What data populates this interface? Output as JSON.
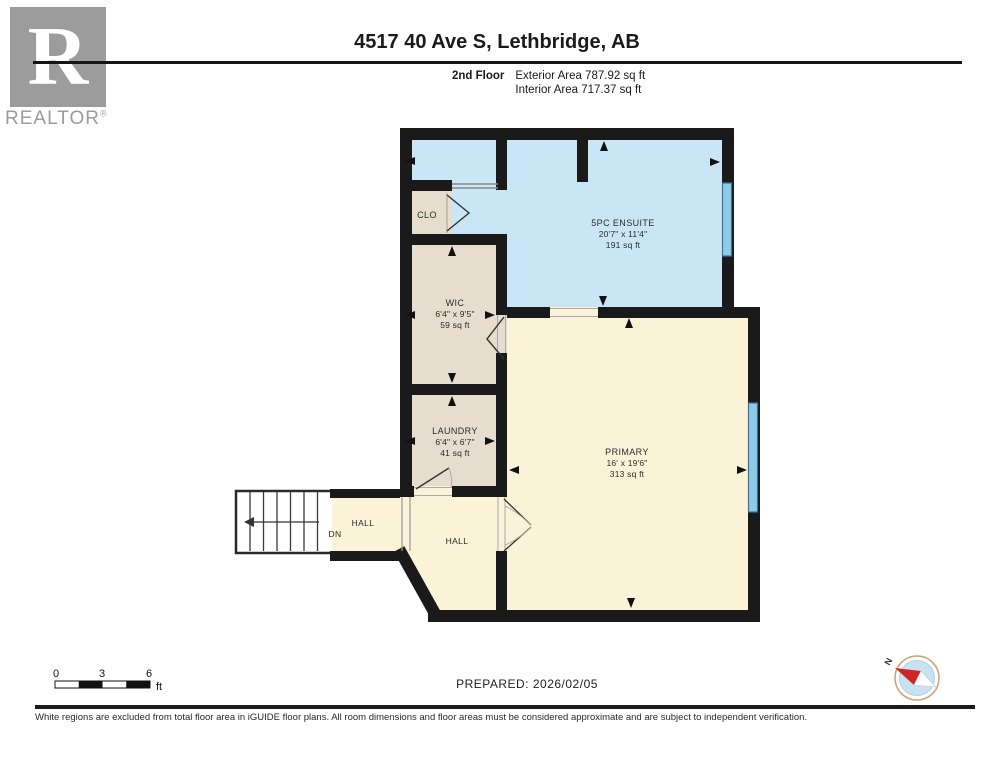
{
  "header": {
    "title": "4517 40 Ave S, Lethbridge, AB",
    "floor_label": "2nd Floor",
    "exterior_area": "Exterior Area 787.92 sq ft",
    "interior_area": "Interior Area 717.37 sq ft",
    "logo_letter": "R",
    "logo_text": "REALTOR",
    "logo_registered": "®"
  },
  "rooms": {
    "ensuite": {
      "name": "5PC ENSUITE",
      "dims": "20'7\" x 11'4\"",
      "area": "191 sq ft"
    },
    "primary": {
      "name": "PRIMARY",
      "dims": "16' x 19'6\"",
      "area": "313 sq ft"
    },
    "wic": {
      "name": "WIC",
      "dims": "6'4\" x 9'5\"",
      "area": "59 sq ft"
    },
    "laundry": {
      "name": "LAUNDRY",
      "dims": "6'4\" x 6'7\"",
      "area": "41 sq ft"
    },
    "closet": {
      "name": "CLO"
    },
    "hall_left": {
      "name": "HALL"
    },
    "hall_center": {
      "name": "HALL"
    },
    "stairs": {
      "label": "DN"
    }
  },
  "footer": {
    "scale": {
      "tick0": "0",
      "tick1": "3",
      "tick2": "6",
      "unit": "ft"
    },
    "prepared": "PREPARED: 2026/02/05",
    "compass_north": "N",
    "disclaimer": "White regions are excluded from total floor area in iGUIDE floor plans. All room dimensions and floor areas must be considered approximate and are subject to independent verification."
  },
  "colors": {
    "wall": "#1a1a1a",
    "ensuite_fill": "#c9e6f7",
    "bedroom_fill": "#fbf3d8",
    "closet_fill": "#e6ddcf",
    "window": "#8ecbe5",
    "window_edge": "#39719f",
    "compass_needle_red": "#cf2525",
    "logo_gray": "#9c9c9c"
  }
}
